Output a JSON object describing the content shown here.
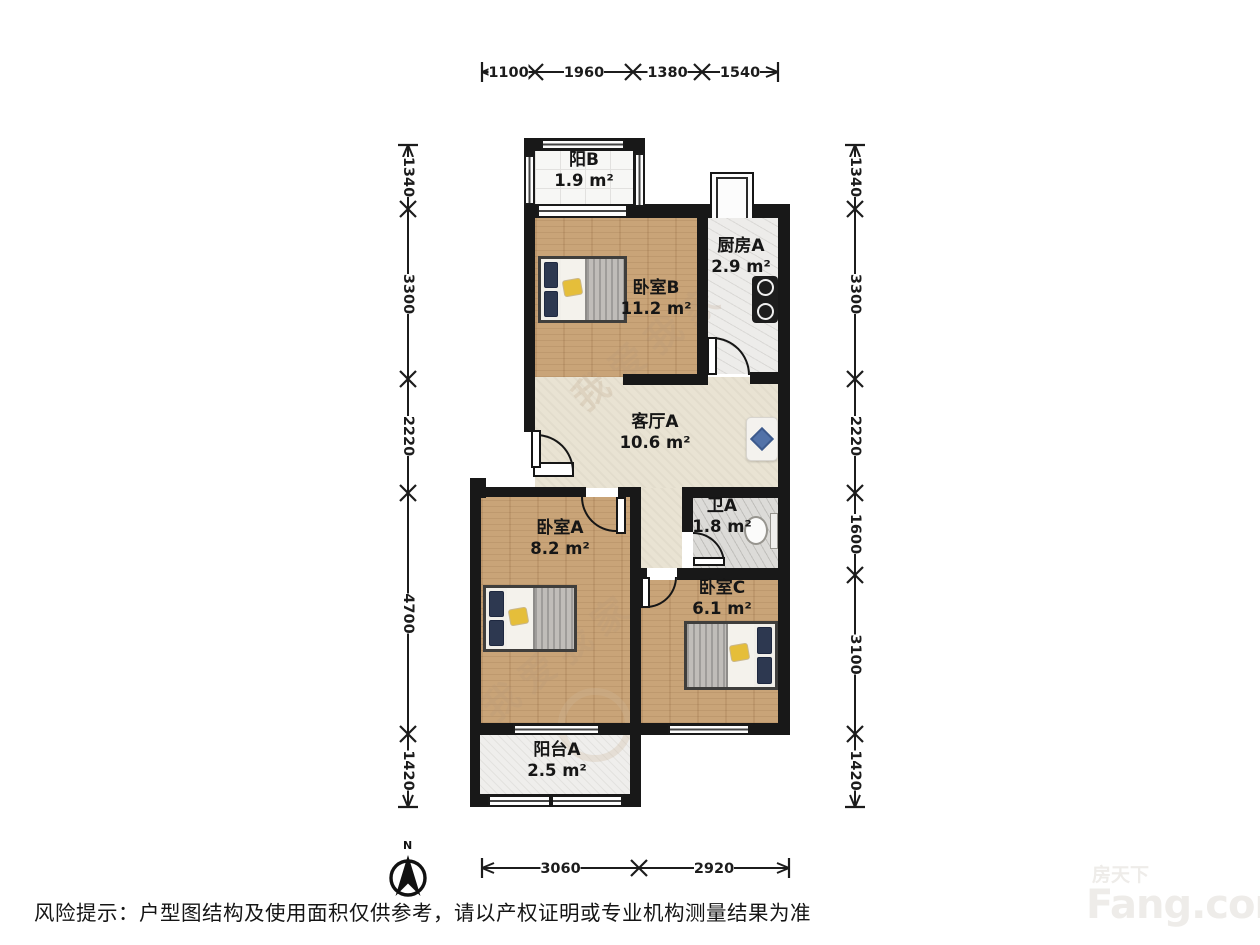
{
  "rooms": {
    "balcony_b": {
      "name": "阳B",
      "area": "1.9 m²"
    },
    "kitchen_a": {
      "name": "厨房A",
      "area": "2.9 m²"
    },
    "bedroom_b": {
      "name": "卧室B",
      "area": "11.2 m²"
    },
    "living_a": {
      "name": "客厅A",
      "area": "10.6 m²"
    },
    "bath_a": {
      "name": "卫A",
      "area": "1.8 m²"
    },
    "bedroom_a": {
      "name": "卧室A",
      "area": "8.2 m²"
    },
    "bedroom_c": {
      "name": "卧室C",
      "area": "6.1 m²"
    },
    "balcony_a": {
      "name": "阳台A",
      "area": "2.5 m²"
    }
  },
  "dimensions": {
    "top": [
      "1100",
      "1960",
      "1380",
      "1540"
    ],
    "left": [
      "1340",
      "3300",
      "2220",
      "4700",
      "1420"
    ],
    "right": [
      "1340",
      "3300",
      "2220",
      "1600",
      "3100",
      "1420"
    ],
    "bottom": [
      "3060",
      "2920"
    ]
  },
  "compass": {
    "north_label": "N"
  },
  "disclaimer": "风险提示：户型图结构及使用面积仅供参考，请以产权证明或专业机构测量结果为准",
  "watermark": {
    "brand_cn": "房天下",
    "brand_en": "Fang.com",
    "diagonal": "我爱我家"
  },
  "colors": {
    "wall": "#181818",
    "wood_floor": "#c9a478",
    "living_floor": "#e9e3d3",
    "pillow_navy": "#2d3850",
    "accent_yellow": "#e5be3a"
  }
}
